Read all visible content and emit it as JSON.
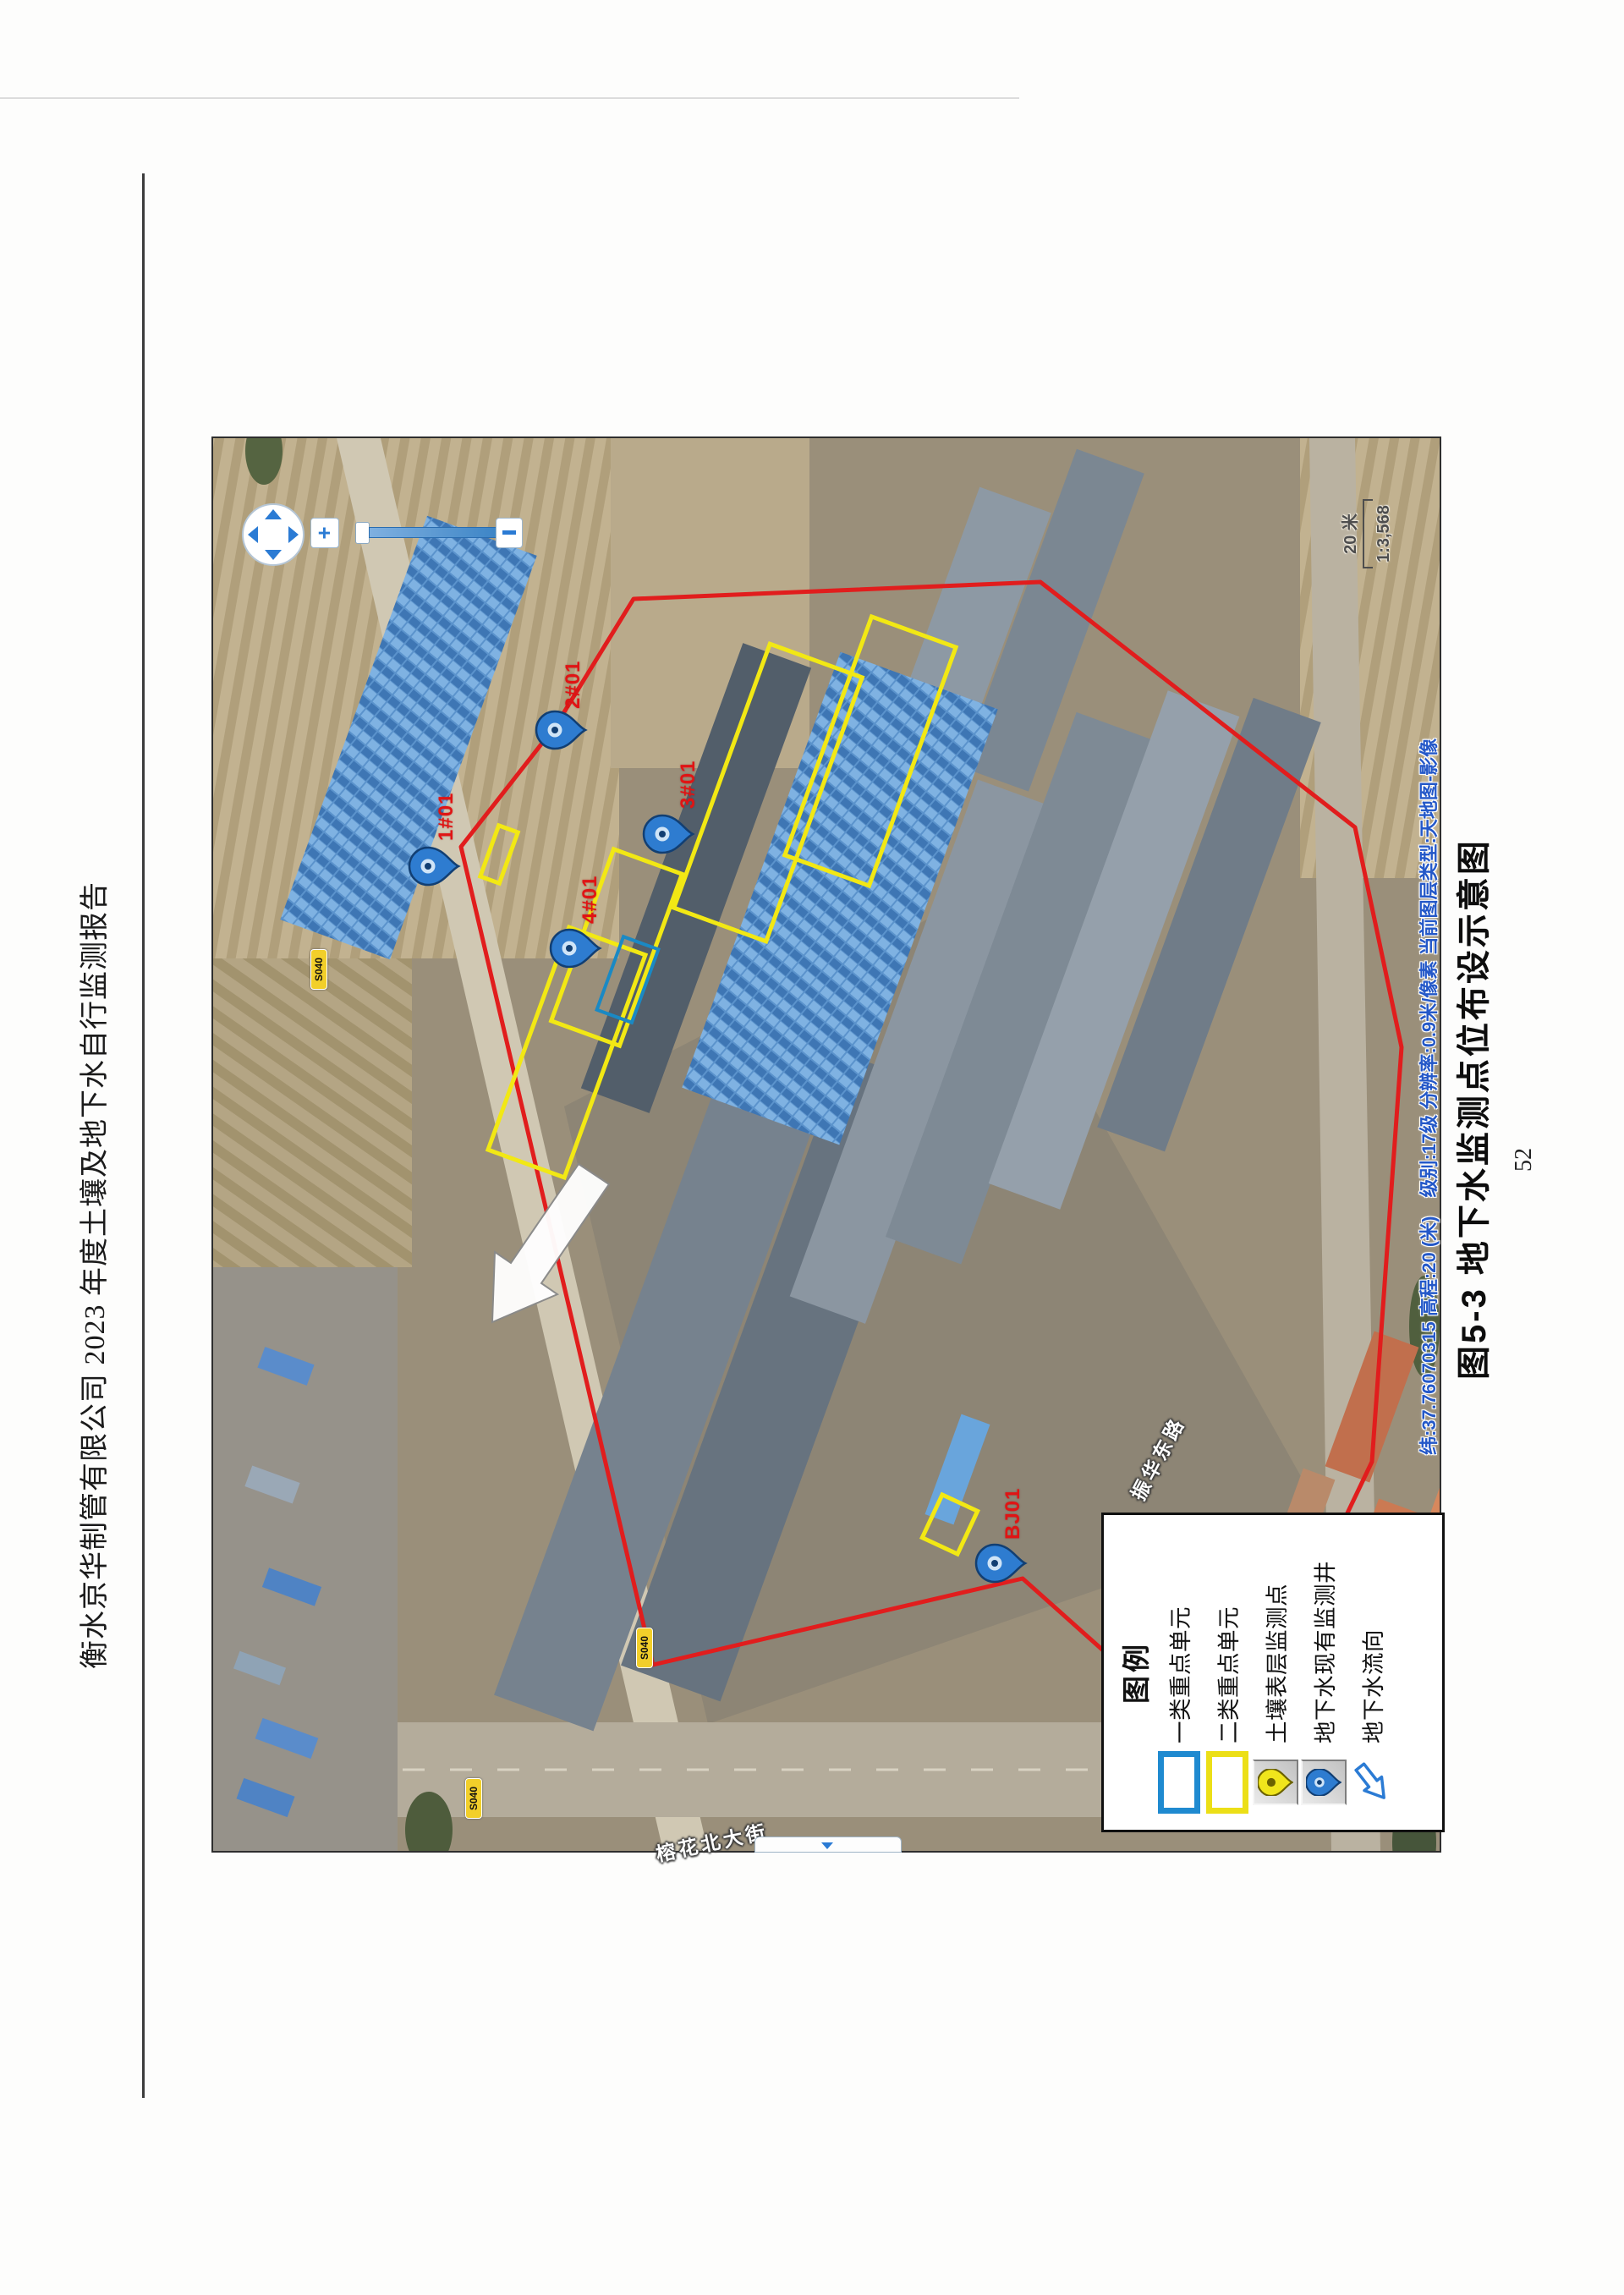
{
  "header": {
    "title": "衡水京华制管有限公司 2023 年度土壤及地下水自行监测报告"
  },
  "figure": {
    "caption": "图5-3  地下水监测点位布设示意图",
    "page_number": "52"
  },
  "map": {
    "status_text": "纬:37.76070315  高程:20 (米)　级别:17级  分辨率:0.9米/像素  当前图层类型:天地图-影像",
    "scale_label": "20 米",
    "scale_ratio": "1:3,568",
    "zoom_controls": {
      "plus": "+"
    },
    "markers": [
      {
        "label": "2#01",
        "type": "groundwater-well"
      },
      {
        "label": "3#01",
        "type": "groundwater-well"
      },
      {
        "label": "1#01",
        "type": "groundwater-well"
      },
      {
        "label": "4#01",
        "type": "groundwater-well"
      },
      {
        "label": "BJ01",
        "type": "groundwater-well"
      }
    ],
    "road_labels": [
      {
        "text": "榕花北大街"
      },
      {
        "text": "振华东路"
      }
    ],
    "shields": [
      {
        "text": "S040"
      },
      {
        "text": "S040"
      },
      {
        "text": "S040"
      }
    ],
    "legend": {
      "title": "图例",
      "items": [
        {
          "label": "一类重点单元",
          "symbol": "blue-rect"
        },
        {
          "label": "二类重点单元",
          "symbol": "yellow-rect"
        },
        {
          "label": "土壤表层监测点",
          "symbol": "yellow-pin"
        },
        {
          "label": "地下水现有监测井",
          "symbol": "blue-pin"
        },
        {
          "label": "地下水流向",
          "symbol": "flow-arrow"
        }
      ]
    }
  }
}
